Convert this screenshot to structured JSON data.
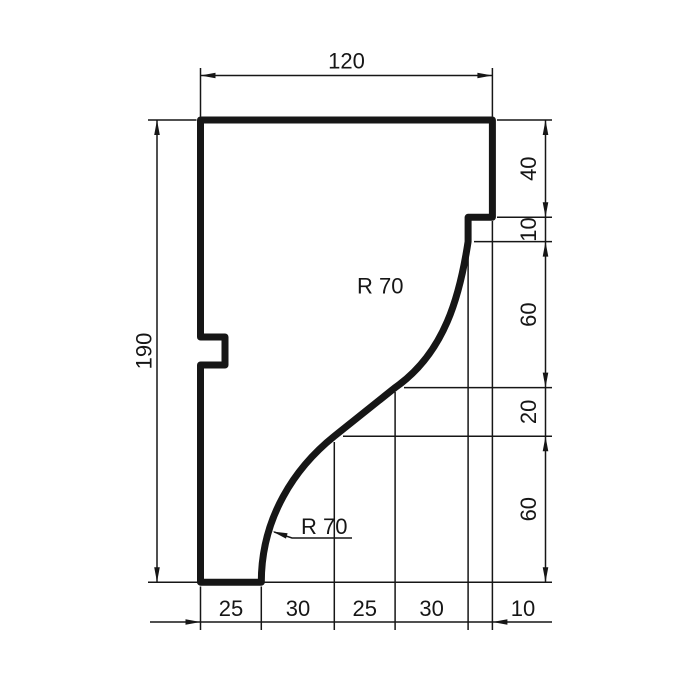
{
  "colors": {
    "background": "#ffffff",
    "ink": "#161616"
  },
  "dimension_labels": {
    "top_width": "120",
    "left_height": "190",
    "right_chain": [
      "40",
      "10",
      "60",
      "20",
      "60"
    ],
    "bottom_chain": [
      "25",
      "30",
      "25",
      "30",
      "10"
    ],
    "radius_callouts": [
      "R 70",
      "R 70"
    ]
  },
  "dimension_values": {
    "top_width": 120,
    "left_height": 190,
    "right_chain": [
      40,
      10,
      60,
      20,
      60
    ],
    "bottom_chain": [
      25,
      30,
      25,
      30,
      10
    ],
    "curve_radius": 70
  }
}
